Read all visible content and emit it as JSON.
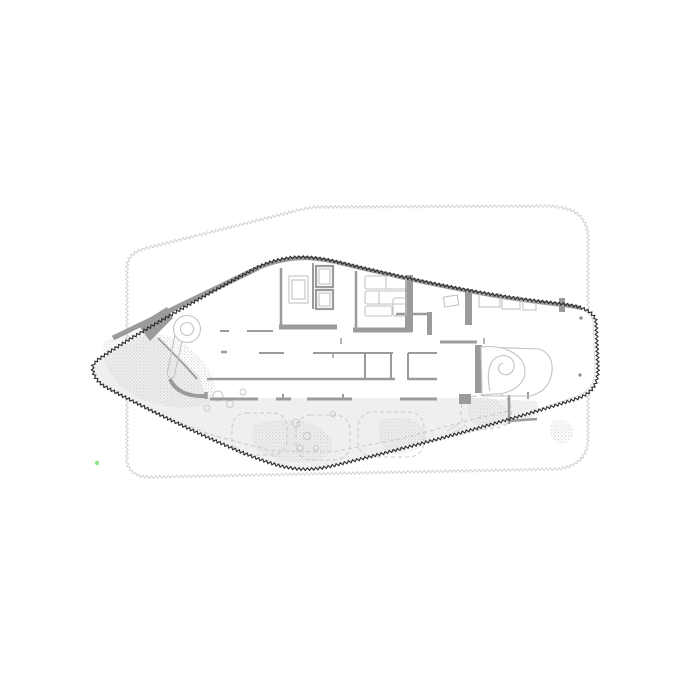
{
  "canvas": {
    "width": 700,
    "height": 700,
    "background": "#ffffff"
  },
  "colors": {
    "floor": "#ffffff",
    "outline": "#2e2e2e",
    "context": "#d2d2d2",
    "innerGlass": "#d8d8d8",
    "wall": "#9b9b9b",
    "furniture": "#c3c3c3",
    "garden": "#efefef",
    "stipple": "#c6c6c6",
    "dashes": "#c8c8c8",
    "column": "#8a8a8a",
    "greenMarker": "#8fe08f",
    "faintMark": "#dcdcdc"
  },
  "style": {
    "zigzag": {
      "amplitude": 1.3,
      "wavelength": 4.2
    },
    "dash": "4,3",
    "bushDash": "2.5,2.5"
  }
}
